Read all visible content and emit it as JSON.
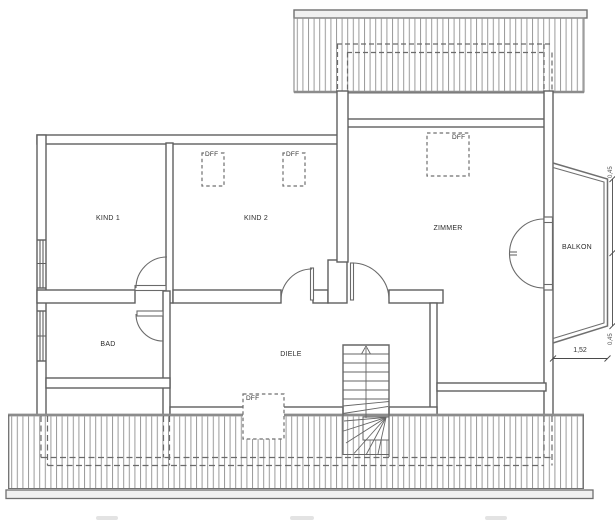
{
  "plan": {
    "title": "upper floor plan",
    "rooms": [
      {
        "id": "kind1",
        "label": "KIND 1"
      },
      {
        "id": "kind2",
        "label": "KIND 2"
      },
      {
        "id": "zimmer",
        "label": "ZIMMER"
      },
      {
        "id": "bad",
        "label": "BAD"
      },
      {
        "id": "diele",
        "label": "DIELE"
      },
      {
        "id": "balkon",
        "label": "BALKON"
      }
    ],
    "skylights": {
      "label": "DFF",
      "count": 4
    },
    "stair": {
      "direction": "up-arrow"
    },
    "dimensions": {
      "balcony_width": "1,52",
      "right_edge_top": "0,45",
      "right_edge_bottom": "0,45"
    },
    "colors": {
      "wall_line": "#5f5f5f",
      "thin_line": "#6e6e6e",
      "hatch_line": "#9a9a9a",
      "hatch_edge": "#8c8c8c",
      "rail_fill": "#f0f0f0",
      "text": "#2b2b2b"
    }
  }
}
